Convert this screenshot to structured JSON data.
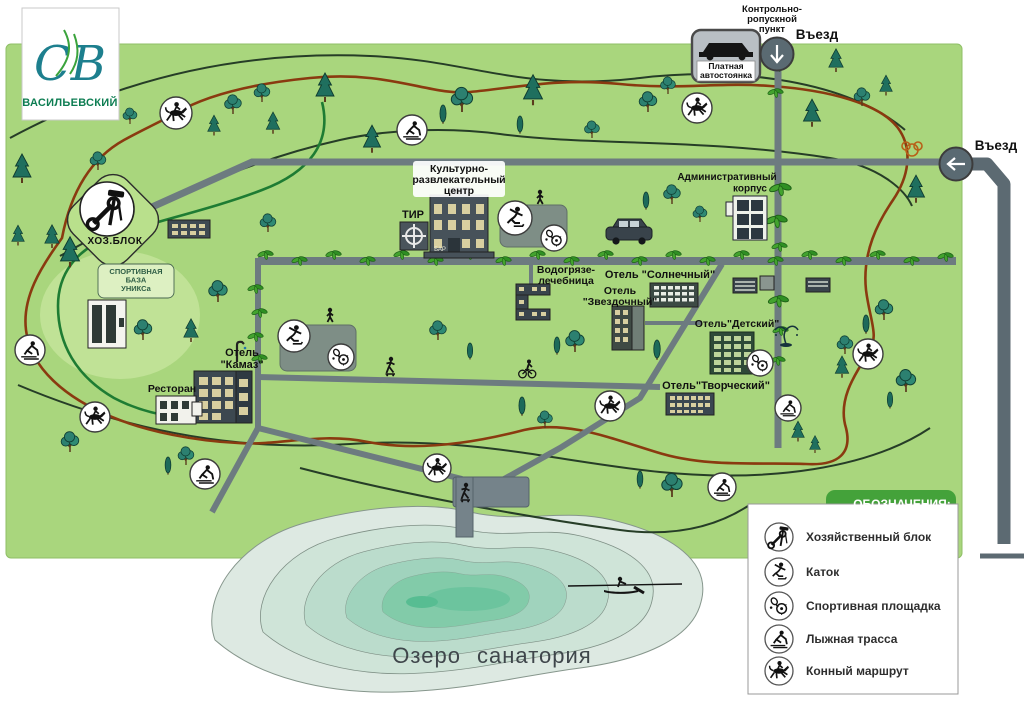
{
  "logo": {
    "monogram": "СВ",
    "title": "ВАСИЛЬЕВСКИЙ"
  },
  "checkpoint": {
    "label_lines": [
      "Контрольно-",
      "ропускной",
      "пункт"
    ],
    "entry_top": "Въезд",
    "entry_right": "Въезд"
  },
  "parking": {
    "lines": [
      "Платная",
      "автостоянка"
    ]
  },
  "places": {
    "krc": [
      "Культурно-",
      "развлекательный",
      "центр"
    ],
    "tir": "ТИР",
    "bar": "БАР",
    "admin": [
      "Административный",
      "корпус"
    ],
    "hozblok": "ХОЗ.БЛОК",
    "uniks": [
      "СПОРТИВНАЯ",
      "БАЗА",
      "УНИКСа"
    ],
    "vodo": [
      "Водогрязе-",
      "лечебница"
    ],
    "hotel_sunny": "Отель \"Солнечный\"",
    "hotel_star": [
      "Отель",
      "\"Звездочный\""
    ],
    "hotel_kids": "Отель\"Детский\"",
    "hotel_creative": "Отель\"Творческий\"",
    "hotel_kamaz": [
      "Отель",
      "\"Камаз\""
    ],
    "restaurant": "Ресторан",
    "lake": "Озеро санатория"
  },
  "legend": {
    "title": "ОБОЗНАЧЕНИЯ:",
    "items": [
      {
        "icon": "tools-icon",
        "label": "Хозяйственный блок"
      },
      {
        "icon": "skater-icon",
        "label": "Каток"
      },
      {
        "icon": "sports-icon",
        "label": "Спортивная площадка"
      },
      {
        "icon": "skier-icon",
        "label": "Лыжная трасса"
      },
      {
        "icon": "horse-icon",
        "label": "Конный маршрут"
      }
    ]
  },
  "colors": {
    "map_green": "#a9d67d",
    "road_gray": "#6d7b80",
    "outer_road": "#5c6a72",
    "horse_trail": "#8a3a10",
    "ski_trail": "#263d27",
    "green_trail": "#1e7c33",
    "lake_shallow": "#dde9e2",
    "lake_deep": "#82cba9",
    "legend_green": "#44a23a",
    "logo_teal": "#1d7f8e",
    "logo_green": "#0d7d52"
  }
}
